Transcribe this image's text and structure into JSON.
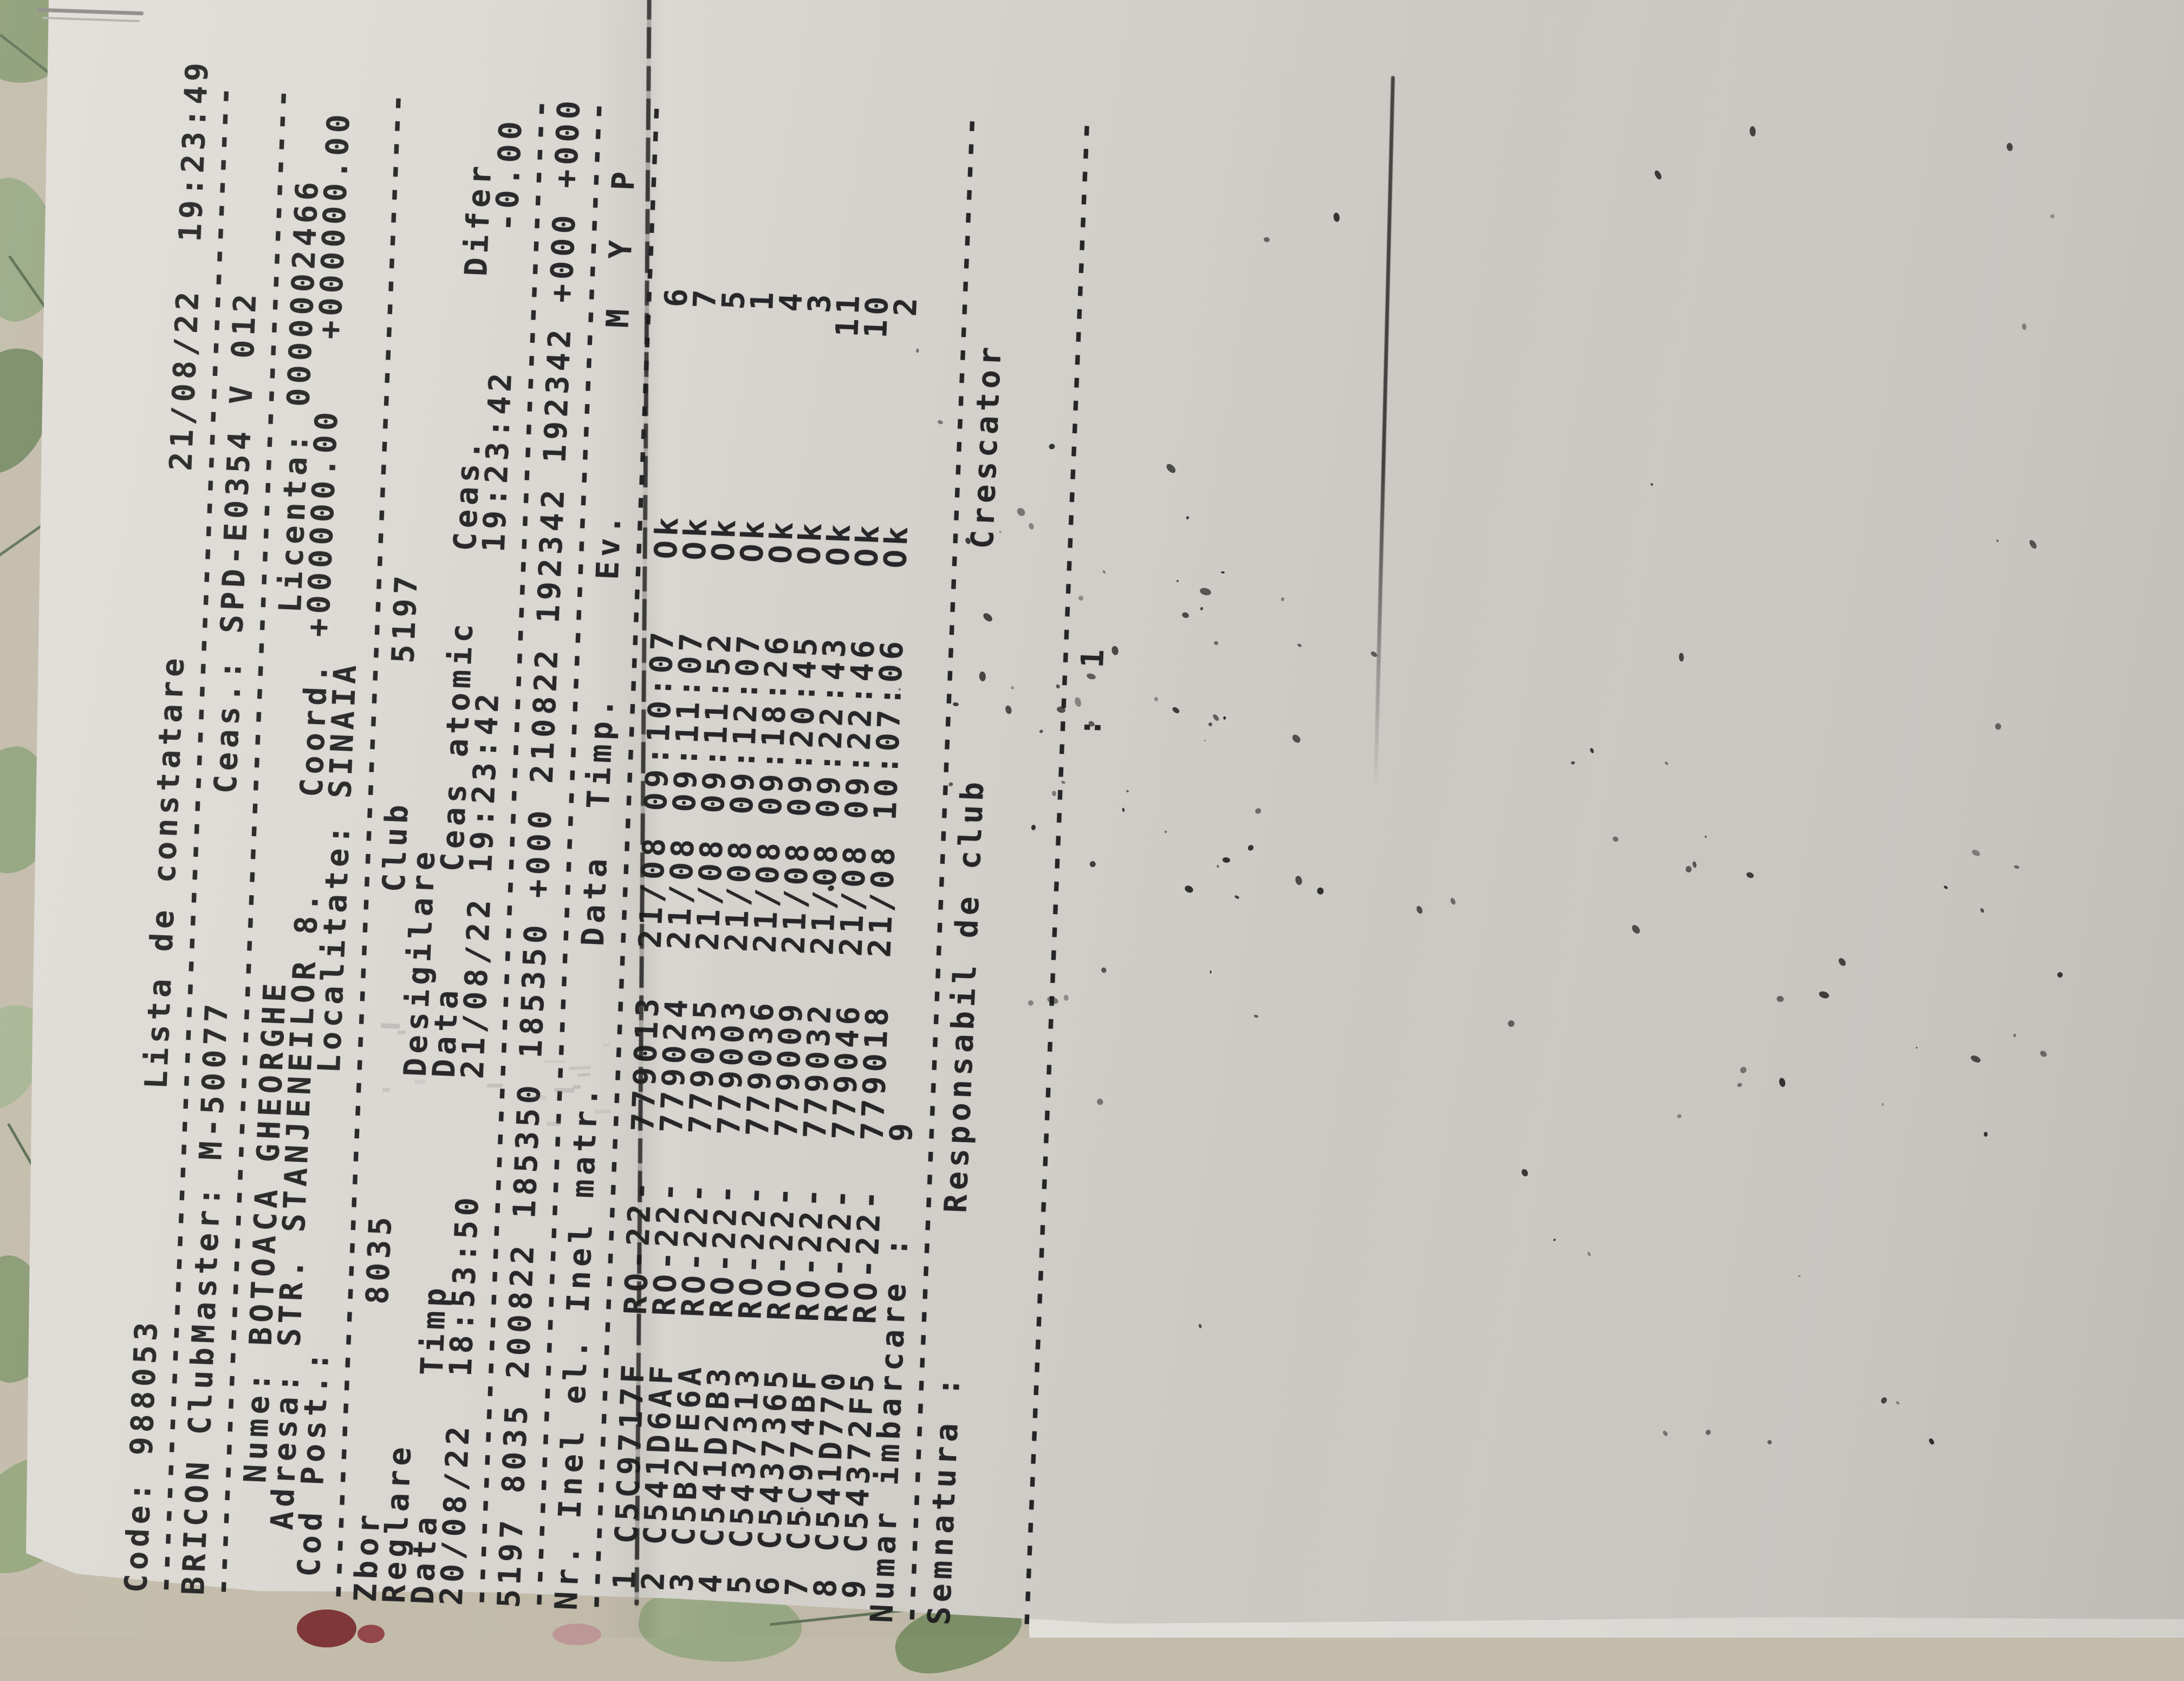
{
  "scene": {
    "colors": {
      "paper": "#d6d3ce",
      "ink": "#1d1d1f",
      "tablecloth": "#c3bcab",
      "leaf_green": "#97a77f",
      "leaf_dark": "#6f8160",
      "flower_red": "#7e3637",
      "flower_pink": "#bd9896",
      "under_sheet": "#e7e5e0",
      "staple_gray": "#8e8d8a"
    }
  },
  "receipt": {
    "device": "BRICON ClubMaster",
    "title": "Lista de constatare",
    "lines": [
      "Code: 988053          Lista de constatare        21/08/22  19:23:49",
      "------------------------------------------------------------------",
      "BRICON ClubMaster: M-50077         Ceas.: SPD-E0354 V 012",
      "------------------------------------------------------------------",
      "     Nume: BOTOACA GHEORGHE                Licenta: 0000002466",
      "   Adresa: STR. STANJENEILOR 8.    Coord. +000000.00   +000000.00",
      " Cod Post.:            Localitate: SINAIA",
      "------------------------------------------------------------------",
      "Zbor         8035              Club      5197",
      "Reglare                Desigilare",
      "Data      Timp         Data     Ceas atomic   Ceas.       Difer",
      "20/08/22  18:53:50     21/08/22 19:23:42      19:23:42      -0.00",
      "------------------------------------------------------------------",
      "5197 8035 200822 185350 185350 +000 210822 192342 192342 +000 +000",
      "------------------------------------------------------------------",
      "Nr. Inel el. Inel matr.      Data  Timp.     Ev.        M  Y  P",
      "------------------------------------------------------------------",
      " 1 C5C9717F  RO-22-  779013  21/08 09:10:07   Ok         6",
      " 2 C541D6AF  RO-22-  779024  21/08 09:11:07   Ok         7",
      " 3 C5B2FE6A  RO-22-  779035  21/08 09:11:52   Ok         5",
      " 4 C541D2B3  RO-22-  779003  21/08 09:12:07   Ok         1",
      " 5 C5437313  RO-22-  779036  21/08 09:18:26   Ok         4",
      " 6 C5437365  RO-22-  779009  21/08 09:20:45   Ok         3",
      " 7 C5C974BF  RO-22-  779032  21/08 09:22:43   Ok        11",
      " 8 C541D770  RO-22-  779046  21/08 09:22:46   Ok        10",
      " 9 C54372F5  RO-22-  779018  21/08 10:07:06   Ok         2",
      "Numar imbarcare :    9",
      "------------------------------------------------------------------",
      "Semnatura :       Responsabil de club          Crescator",
      "",
      "",
      "------------------------------------------------------------------",
      "                                       :  1"
    ],
    "fields": {
      "code": "988053",
      "printed_at": "21/08/22  19:23:49",
      "clubmaster_id": "M-50077",
      "ceas": "SPD-E0354 V 012",
      "nume": "BOTOACA GHEORGHE",
      "adresa": "STR. STANJENEILOR 8.",
      "cod_post": "",
      "localitate": "SINAIA",
      "licenta": "0000002466",
      "coord": "+000000.00   +000000.00",
      "zbor": "8035",
      "club": "5197",
      "reglare": {
        "data": "20/08/22",
        "timp": "18:53:50"
      },
      "desigilare": {
        "data": "21/08/22",
        "ceas_atomic": "19:23:42",
        "ceas": "19:23:42",
        "difer": "-0.00"
      },
      "control_line": "5197 8035 200822 185350 185350 +000 210822 192342 192342 +000 +000",
      "numar_imbarcare": "9",
      "semnatura_labels": [
        "Semnatura :",
        "Responsabil de club",
        "Crescator"
      ],
      "page_mark": ":  1"
    },
    "table": {
      "headers": [
        "Nr.",
        "Inel el.",
        "Inel matr.",
        "Data",
        "Timp.",
        "Ev.",
        "M",
        "Y",
        "P"
      ],
      "rows": [
        [
          "1",
          "C5C9717F",
          "RO-22-",
          "779013",
          "21/08",
          "09:10:07",
          "Ok",
          "6"
        ],
        [
          "2",
          "C541D6AF",
          "RO-22-",
          "779024",
          "21/08",
          "09:11:07",
          "Ok",
          "7"
        ],
        [
          "3",
          "C5B2FE6A",
          "RO-22-",
          "779035",
          "21/08",
          "09:11:52",
          "Ok",
          "5"
        ],
        [
          "4",
          "C541D2B3",
          "RO-22-",
          "779003",
          "21/08",
          "09:12:07",
          "Ok",
          "1"
        ],
        [
          "5",
          "C5437313",
          "RO-22-",
          "779036",
          "21/08",
          "09:18:26",
          "Ok",
          "4"
        ],
        [
          "6",
          "C5437365",
          "RO-22-",
          "779009",
          "21/08",
          "09:20:45",
          "Ok",
          "3"
        ],
        [
          "7",
          "C5C974BF",
          "RO-22-",
          "779032",
          "21/08",
          "09:22:43",
          "Ok",
          "11"
        ],
        [
          "8",
          "C541D770",
          "RO-22-",
          "779046",
          "21/08",
          "09:22:46",
          "Ok",
          "10"
        ],
        [
          "9",
          "C54372F5",
          "RO-22-",
          "779018",
          "21/08",
          "10:07:06",
          "Ok",
          "2"
        ]
      ]
    }
  }
}
